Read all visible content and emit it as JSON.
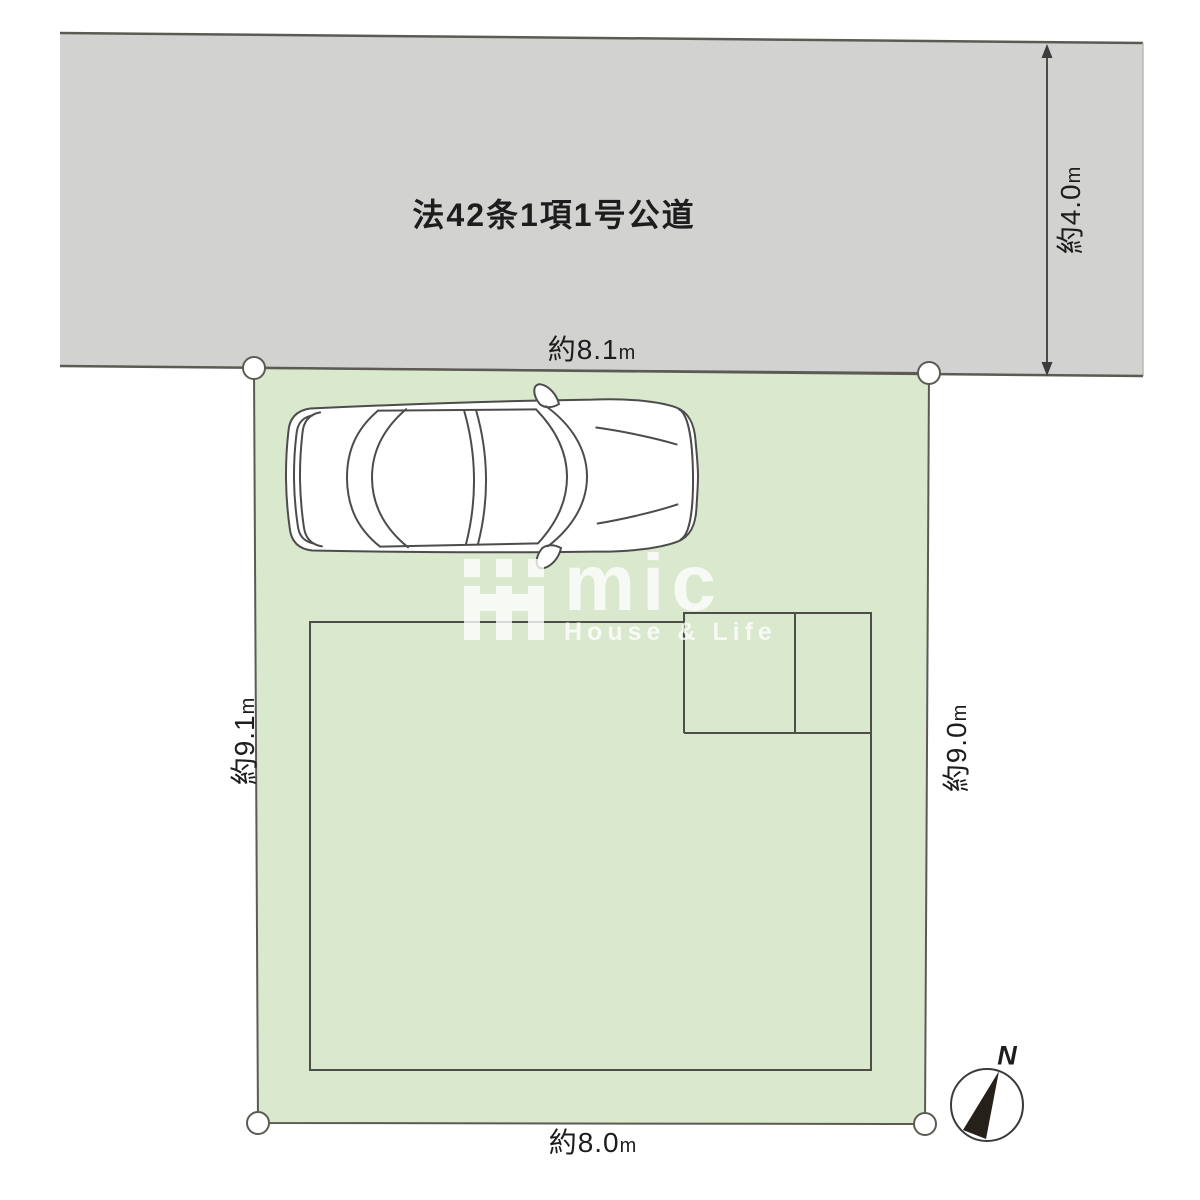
{
  "road": {
    "label": "法42条1項1号公道",
    "fill": "#d2d2d1",
    "width_dim": {
      "value": "約4.0",
      "unit": "m"
    }
  },
  "lot": {
    "fill": "#dae8ce",
    "dims": {
      "top": {
        "value": "約8.1",
        "unit": "m"
      },
      "left": {
        "value": "約9.1",
        "unit": "m"
      },
      "right": {
        "value": "約9.0",
        "unit": "m"
      },
      "bottom": {
        "value": "約8.0",
        "unit": "m"
      }
    }
  },
  "compass": {
    "label": "N"
  },
  "watermark": {
    "brand": "mic",
    "tagline": "House & Life"
  },
  "colors": {
    "boundary_line": "#5b5b54",
    "building_line": "#4e4e48",
    "car_line": "#4c4c4c",
    "needle": "#26201a",
    "text": "#1d1d1d"
  }
}
